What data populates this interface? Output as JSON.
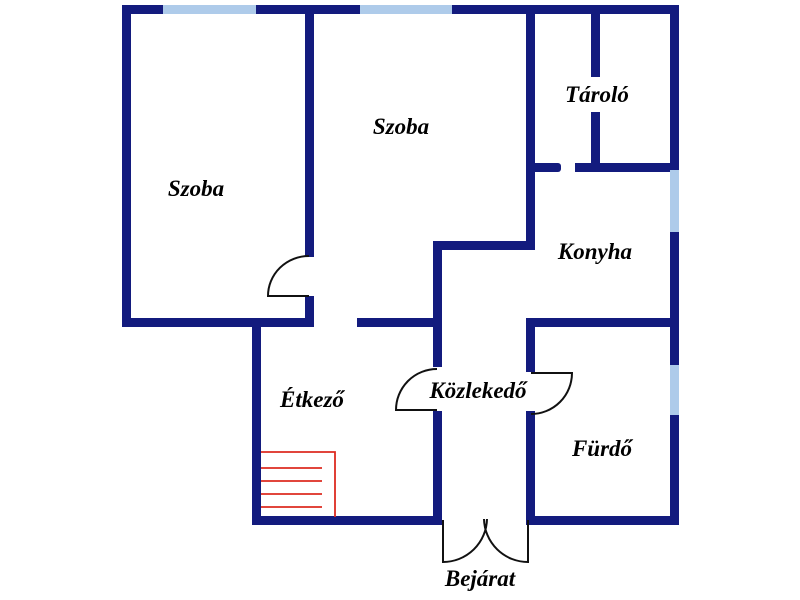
{
  "plan": {
    "name": "apartment-floor-plan",
    "rooms": [
      {
        "id": "szoba-left",
        "label": "Szoba"
      },
      {
        "id": "szoba-middle",
        "label": "Szoba"
      },
      {
        "id": "tarolo",
        "label": "Tároló"
      },
      {
        "id": "konyha",
        "label": "Konyha"
      },
      {
        "id": "etkezo",
        "label": "Étkező"
      },
      {
        "id": "kozlekedo",
        "label": "Közlekedő"
      },
      {
        "id": "furdo",
        "label": "Fürdő"
      },
      {
        "id": "bejarat",
        "label": "Bejárat"
      }
    ]
  },
  "colors": {
    "wall": "#131b7e",
    "window": "#aecbea",
    "door": "#111111",
    "stairs": "#dd2b20",
    "text": "#000000",
    "background": "#ffffff"
  }
}
